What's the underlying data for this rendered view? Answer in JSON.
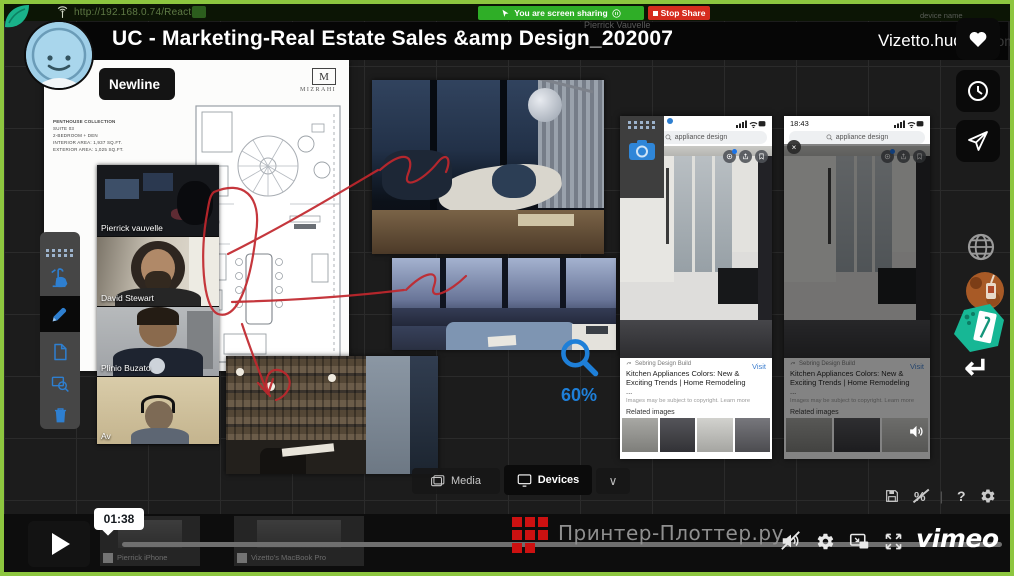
{
  "colors": {
    "frame_green": "#8dc63f",
    "toolbar_blue": "#2e7fd0",
    "share_green": "#2fae27",
    "stop_red": "#d62c1e",
    "annotation_red": "#c1272d",
    "zoom_blue": "#1e7fd8",
    "watermark_red": "#cc1111"
  },
  "browser": {
    "url": "http://192.168.0.74/Reactiv/",
    "sharing_banner": "You are screen sharing",
    "stop_share_label": "Stop Share",
    "presenter": "Pierrick Vauvelle"
  },
  "header": {
    "title": "UC - Marketing-Real Estate Sales &amp Design_202007",
    "app_name": "Vizetto.huddle",
    "device_label": "device name",
    "room_label": "room"
  },
  "overlay": {
    "newline_label": "Newline",
    "zoom_level": "60%"
  },
  "document": {
    "header_fragment": "E O",
    "brand_initial": "M",
    "brand": "MIZRAHI",
    "specs": [
      "PENTHOUSE COLLECTION",
      "SUITE 03",
      "2-BEDROOM + DEN",
      "INTERIOR AREA: 1,937 SQ.FT.",
      "EXTERIOR AREA: 1,025 SQ.FT."
    ]
  },
  "participants": [
    {
      "name": "Pierrick vauvelle"
    },
    {
      "name": "David Stewart"
    },
    {
      "name": "Plinio Buzato"
    },
    {
      "name": "Av"
    }
  ],
  "phone": {
    "status_time": "18:43",
    "search_query": "appliance design",
    "result_source": "Sebring Design Build",
    "result_title": "Kitchen Appliances Colors: New & Exciting Trends | Home Remodeling ...",
    "visit_label": "Visit",
    "copyright_note": "Images may be subject to copyright. Learn more",
    "related_label": "Related images"
  },
  "tabs": {
    "media": "Media",
    "devices": "Devices"
  },
  "player": {
    "seek_tooltip": "01:38",
    "watermark_text": "Принтер-Плоттер.ру",
    "vimeo_logo": "vimeo",
    "device_tiles": [
      {
        "label": "Pierrick iPhone"
      },
      {
        "label": "Vizetto's MacBook Pro"
      }
    ]
  },
  "glyphs": {
    "help": "?",
    "return_arrow": "↵",
    "close": "×",
    "chevron_down": "∨"
  }
}
